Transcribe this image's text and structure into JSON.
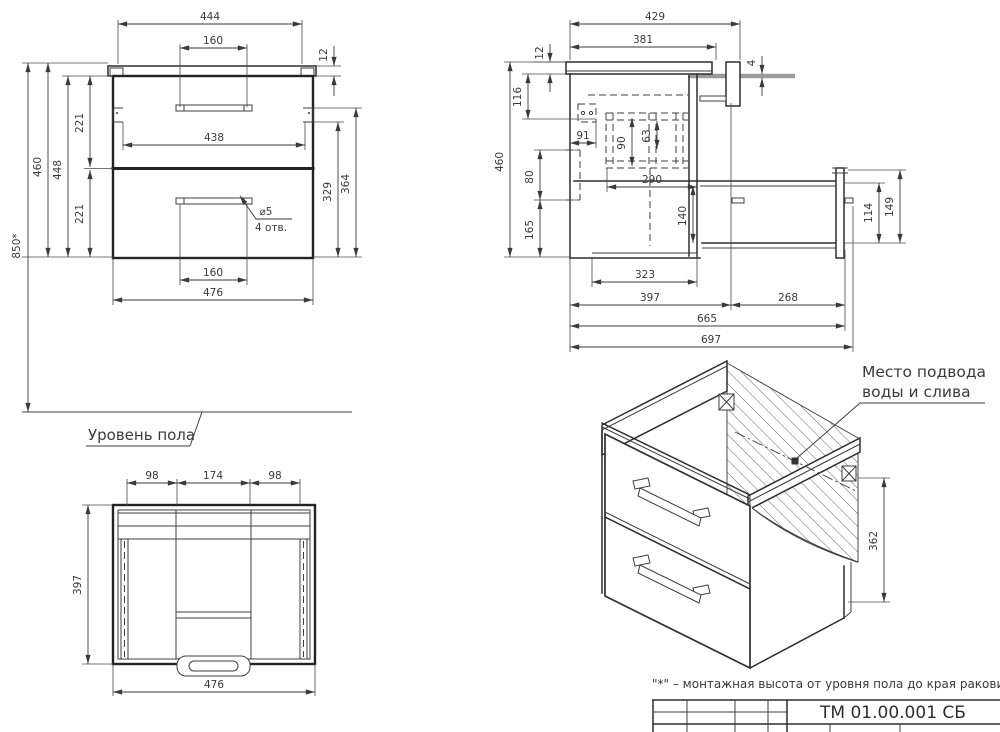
{
  "front_view": {
    "dims": {
      "top_width": "444",
      "handle_top": "160",
      "overhang": "12",
      "mount_height": "850*",
      "total_height": "460",
      "body_height": "448",
      "upper_section": "221",
      "lower_section": "221",
      "inner_width": "438",
      "right_inner": "329",
      "right_outer": "364",
      "handle_bottom": "160",
      "bottom_width": "476"
    },
    "hole_dia": "⌀5",
    "hole_count": "4 отв."
  },
  "floor_label": "Уровень пола",
  "top_view": {
    "dims": {
      "left": "98",
      "center": "174",
      "right": "98",
      "depth": "397",
      "width": "476"
    }
  },
  "side_view": {
    "dims": {
      "top_width": "429",
      "top_inner": "381",
      "thickness": "12",
      "rail": "4",
      "hole_top": "116",
      "hole_front": "91",
      "runner_height": "90",
      "runner_inner": "63",
      "runner_length": "290",
      "niche_height": "80",
      "lower_height": "165",
      "total_height": "460",
      "drawer_inner": "140",
      "bottom_inner": "323",
      "depth": "397",
      "extension": "268",
      "total_extended": "665",
      "overall": "697",
      "drawer_side": "114",
      "drawer_front": "149"
    }
  },
  "iso_view": {
    "label_line1": "Место подвода",
    "label_line2": "воды и слива",
    "drawer_height": "362"
  },
  "footnote": "\"*\" – монтажная высота от уровня пола до края раковины",
  "title_block": {
    "number": "ТМ 01.00.001 СБ"
  }
}
